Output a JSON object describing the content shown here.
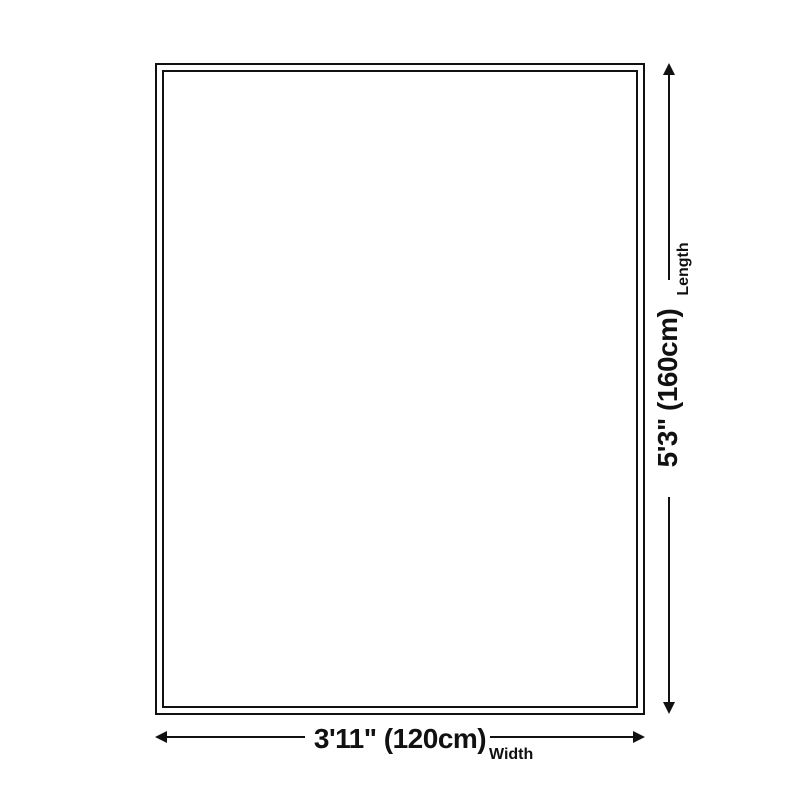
{
  "diagram": {
    "length": {
      "label": "Length",
      "value": "5'3\" (160cm)"
    },
    "width": {
      "label": "Width",
      "value": "3'11\" (120cm)"
    },
    "colors": {
      "line": "#111111",
      "background": "#ffffff"
    }
  }
}
